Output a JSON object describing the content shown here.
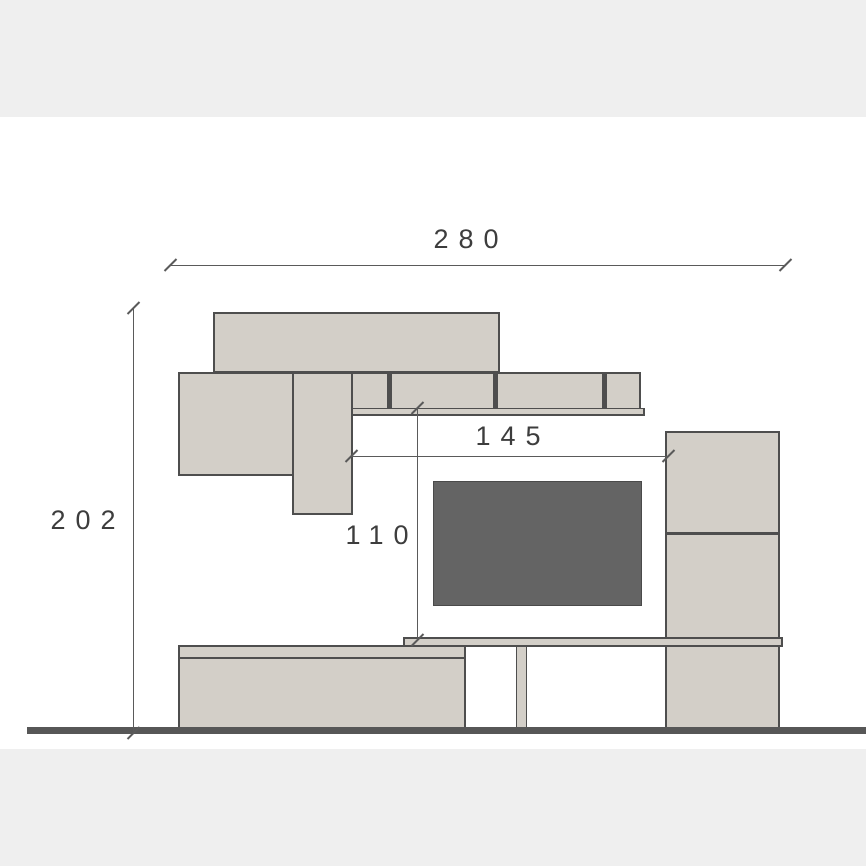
{
  "dimensions": {
    "overall_width": {
      "label": "280"
    },
    "overall_height": {
      "label": "202"
    },
    "middle_width": {
      "label": "145"
    },
    "middle_height": {
      "label": "110"
    }
  },
  "colors": {
    "beige": "#d3cfc8",
    "outline": "#4e4e4e",
    "tv": "#646464",
    "tv-edge": "#4a4a4a",
    "floor": "#575757",
    "band": "#efefef",
    "dim": "#5a5a5a",
    "text": "#3d3d3d"
  }
}
